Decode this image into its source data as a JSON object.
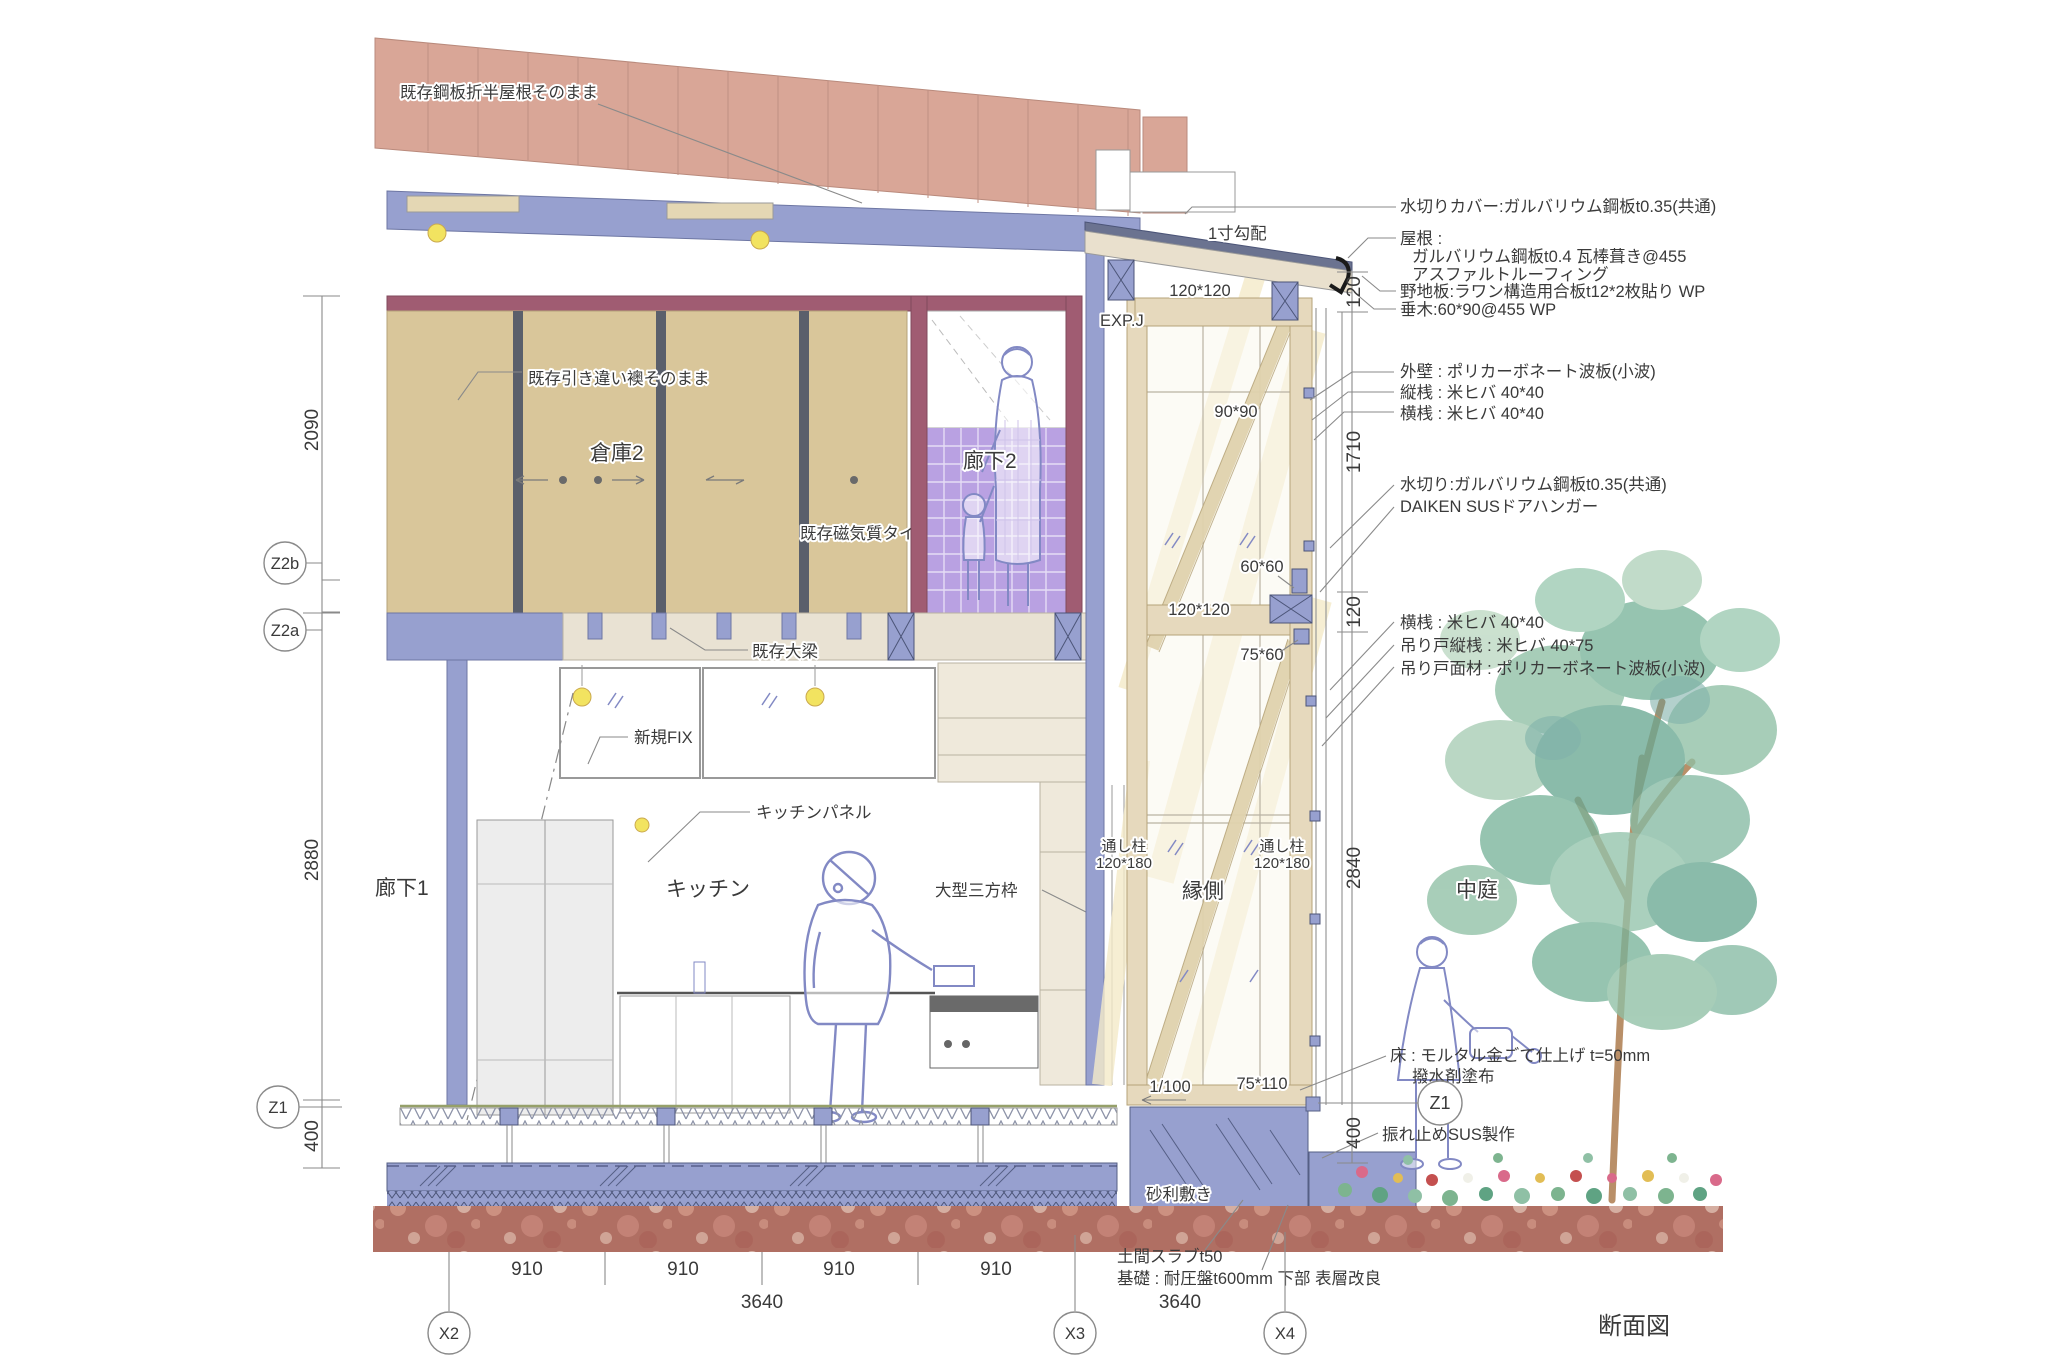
{
  "title": "断面図",
  "colors": {
    "roof_salmon": "#d9a697",
    "structure_blue": "#97a0cf",
    "fusuma_tan": "#d9c69a",
    "mauve": "#a05c72",
    "tile_purple": "#b9a1e2",
    "ceiling_beige": "#e9e2d3",
    "wood_tan": "#e6d9bd",
    "glass": "#fbf8ee",
    "light_streak": "#f5ebc9",
    "soil": "#b06f63",
    "sketch_blue": "#8289c4",
    "foliage_green": "#79b49b",
    "light_yellow": "#f2e360"
  },
  "labels": {
    "roof_existing": "既存鋼板折半屋根そのまま",
    "fusuma_note": "既存引き違い襖そのまま",
    "storage2": "倉庫2",
    "corridor2": "廊下2",
    "tile_note": "既存磁気質タイル",
    "beam_note": "既存大梁",
    "fix_note": "新規FIX",
    "kitchen_panel": "キッチンパネル",
    "kitchen": "キッチン",
    "frame_note": "大型三方枠",
    "corridor1": "廊下1",
    "engawa": "縁側",
    "courtyard": "中庭",
    "expj": "EXP.J",
    "slope": "1寸勾配",
    "floor_slope": "1/100",
    "gravel": "砂利敷き",
    "doma_slab": "土間スラブt50",
    "foundation": "基礎 : 耐圧盤t600mm 下部 表層改良"
  },
  "posts": {
    "left_name": "通し柱",
    "left_size": "120*180",
    "right_name": "通し柱",
    "right_size": "120*180"
  },
  "sizes": {
    "top_beam": "120*120",
    "brace": "90*90",
    "block": "60*60",
    "mid_rail": "120*120",
    "rail_small": "75*60",
    "sill": "75*110"
  },
  "annot": {
    "mizukiri_cover": "水切りカバー:ガルバリウム鋼板t0.35(共通)",
    "roof": [
      "屋根 :",
      "ガルバリウム鋼板t0.4 瓦棒葺き@455",
      "アスファルトルーフィング",
      "野地板:ラワン構造用合板t12*2枚貼り WP",
      "垂木:60*90@455 WP"
    ],
    "wall": [
      "外壁 : ポリカーボネート波板(小波)",
      "縦桟 : 米ヒバ 40*40",
      "横桟 : 米ヒバ 40*40"
    ],
    "mizukiri": "水切り:ガルバリウム鋼板t0.35(共通)",
    "daiken": "DAIKEN SUSドアハンガー",
    "door": [
      "横桟 : 米ヒバ 40*40",
      "吊り戸縦桟 : 米ヒバ 40*75",
      "吊り戸面材 : ポリカーボネート波板(小波)"
    ],
    "floor": [
      "床 : モルタル金ごて仕上げ t=50mm",
      "撥水剤塗布"
    ],
    "sus": "振れ止めSUS製作"
  },
  "dims": {
    "left_2090": "2090",
    "left_2880": "2880",
    "left_400": "400",
    "right_120a": "120",
    "right_1710": "1710",
    "right_120b": "120",
    "right_2840": "2840",
    "right_400": "400",
    "b910_1": "910",
    "b910_2": "910",
    "b910_3": "910",
    "b910_4": "910",
    "span_left": "3640",
    "span_right": "3640"
  },
  "bubbles": {
    "z2b": "Z2b",
    "z2a": "Z2a",
    "z1_left": "Z1",
    "z1_right": "Z1",
    "x2": "X2",
    "x3": "X3",
    "x4": "X4"
  }
}
